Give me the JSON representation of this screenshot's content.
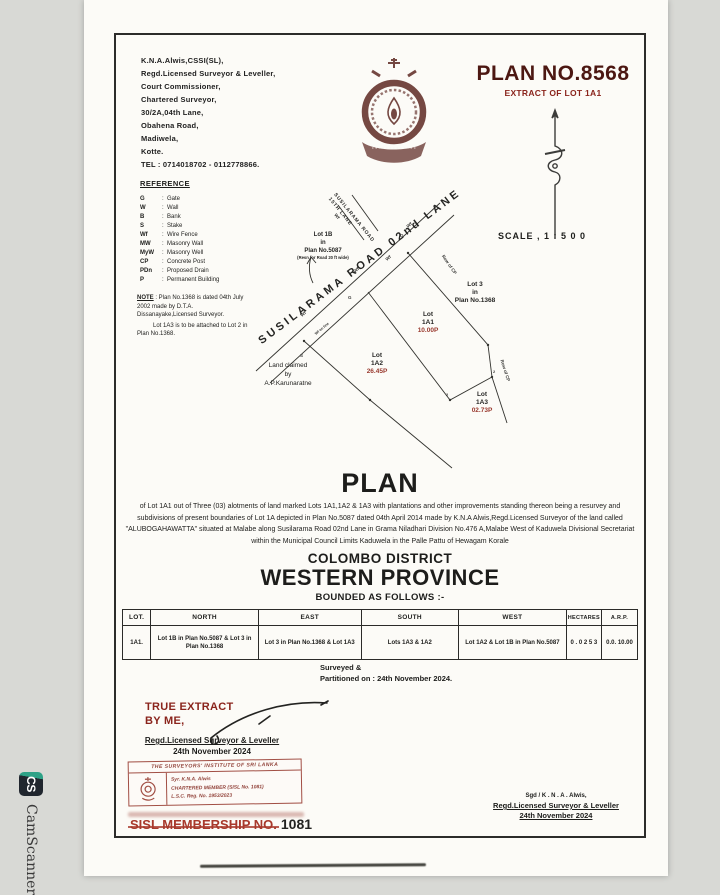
{
  "watermark": {
    "icon": "CS",
    "label": "CamScanner"
  },
  "letterhead": {
    "lines": [
      "K.N.A.Alwis,CSSI(SL),",
      "Regd.Licensed Surveyor & Leveller,",
      "Court Commissioner,",
      "Chartered Surveyor,",
      "30/2A,04th Lane,",
      "Obahena Road,",
      "Madiwela,",
      "Kotte.",
      "TEL : 0714018702 - 0112778866."
    ]
  },
  "titleblock": {
    "plan_no": "PLAN NO.8568",
    "extract": "EXTRACT OF LOT 1A1",
    "scale": "SCALE , 1 : 5 0 0"
  },
  "reference": {
    "title": "REFERENCE",
    "items": [
      {
        "a": "G",
        "m": "Gate"
      },
      {
        "a": "W",
        "m": "Wall"
      },
      {
        "a": "B",
        "m": "Bank"
      },
      {
        "a": "S",
        "m": "Stake"
      },
      {
        "a": "Wf",
        "m": "Wire Fence"
      },
      {
        "a": "MW",
        "m": "Masonry Wall"
      },
      {
        "a": "MyW",
        "m": "Masonry Well"
      },
      {
        "a": "CP",
        "m": "Concrete Post"
      },
      {
        "a": "PDn",
        "m": "Proposed Drain"
      },
      {
        "a": "P",
        "m": "Permanent Building"
      }
    ]
  },
  "note": {
    "label": "NOTE",
    "text1": " : Plan No.1368 is dated 04th July 2002 made by D.T.A. Dissanayake,Licensed Surveyor.",
    "text2": "Lot 1A3 is to be attached to Lot 2 in Plan No.1368."
  },
  "drawing": {
    "road_main": "SUSILARAMA ROAD 02nd LANE",
    "road_lane_1": "SUSILARAMA ROAD",
    "road_lane_2": "15TH LANE",
    "lot1b": {
      "l1": "Lot 1B",
      "l2": "in",
      "l3": "Plan No.5087",
      "l4": "(Resn for Road 20 ft wide)"
    },
    "lot3": {
      "l1": "Lot 3",
      "l2": "in",
      "l3": "Plan No.1368"
    },
    "lot1a1": {
      "l1": "Lot",
      "l2": "1A1",
      "extent": "10.00P"
    },
    "lot1a2": {
      "l1": "Lot",
      "l2": "1A2",
      "extent": "26.45P"
    },
    "lot1a3": {
      "l1": "Lot",
      "l2": "1A3",
      "extent": "02.73P"
    },
    "land_claim": {
      "l1": "Land claimed",
      "l2": "by",
      "l3": "A.P.Karunaratne"
    },
    "row_of_cp": "Row of CP",
    "markers": {
      "wf": "Wf",
      "g": "G",
      "s": "S",
      "two": "2",
      "wf_on_line": "Wf on line"
    }
  },
  "plan_section": {
    "title": "PLAN",
    "body": "of Lot 1A1 out of Three (03) alotments of land marked Lots 1A1,1A2 & 1A3 with plantations and other improvements standing thereon being a resurvey and subdivisions of present boundaries of Lot 1A depicted in Plan No.5087 dated 04th April 2014 made by K.N.A Alwis,Regd.Licensed Surveyor of the land called \"ALUBOGAHAWATTA\" situated at Malabe along Susilarama Road 02nd Lane in Grama Niladhari Division No.476 A,Malabe West of Kaduwela Divisional Secretariat within the Municipal Council Limits Kaduwela in the Palle Pattu of Hewagam Korale",
    "district": "COLOMBO DISTRICT",
    "province": "WESTERN PROVINCE",
    "bounded": "BOUNDED AS FOLLOWS :-"
  },
  "table": {
    "headers": [
      "LOT.",
      "NORTH",
      "EAST",
      "SOUTH",
      "WEST",
      "HECTARES",
      "A.R.P."
    ],
    "rows": [
      [
        "1A1.",
        "Lot 1B in Plan No.5087 & Lot 3 in Plan No.1368",
        "Lot 3 in Plan No.1368 & Lot 1A3",
        "Lots 1A3 & 1A2",
        "Lot 1A2 & Lot 1B in Plan No.5087",
        "0 . 0 2 5 3",
        "0.0. 10.00"
      ]
    ]
  },
  "surveyed": {
    "l1": "Surveyed &",
    "l2": "Partitioned  on : 24th November 2024."
  },
  "true_extract": {
    "l1": "TRUE EXTRACT",
    "l2": "BY ME,",
    "sub1": "Regd.Licensed Surveyor & Leveller",
    "sub2": "24th November 2024"
  },
  "stamp": {
    "banner": "THE SURVEYORS' INSTITUTE OF SRI LANKA",
    "line1": "Syr. K.N.A. Alwis",
    "line2": "CHARTERED MEMBER (SISL No. 1081)",
    "line3": "L.S.C. Reg. No. 1953/2023"
  },
  "membership": {
    "label": "SISL MEMBERSHIP NO.",
    "value": "1081"
  },
  "signature": {
    "l1": "Sgd / K . N . A . Alwis,",
    "l2": "Regd.Licensed Surveyor & Leveller",
    "l3": "24th November 2024"
  }
}
